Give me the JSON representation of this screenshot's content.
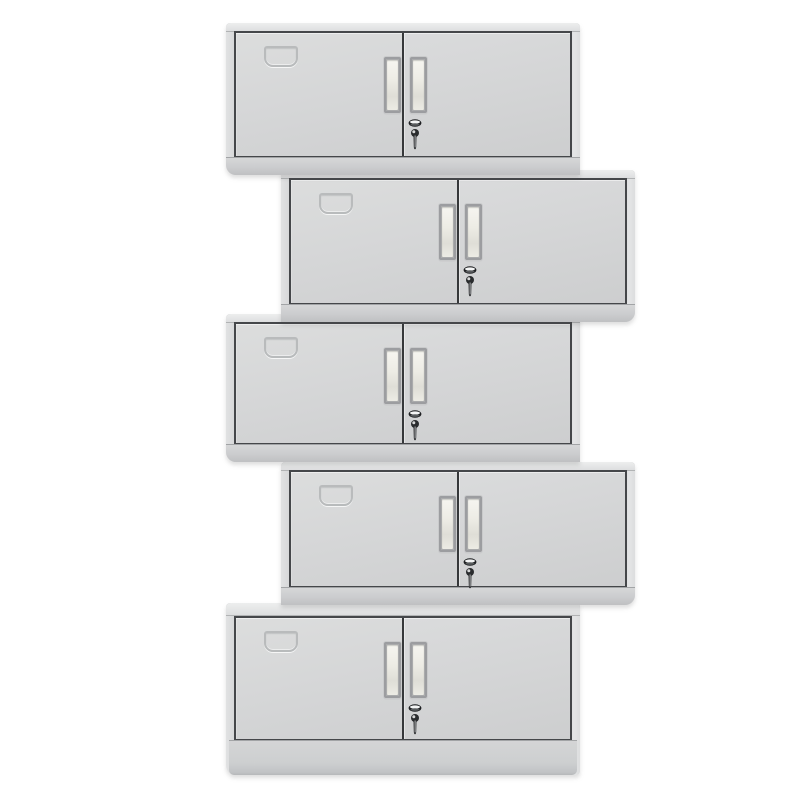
{
  "scene": {
    "type": "product-photo",
    "subject": "Five identical light-gray two-door steel office cabinets stacked vertically in an alternating left/right zigzag offset",
    "background_color": "#ffffff",
    "visible_text": "none"
  },
  "colors": {
    "cabinet_body": "#d5d6d7",
    "door_panel_light": "#dcdddd",
    "door_panel_dark": "#cfd0d1",
    "frame_line": "#45474a",
    "door_gap_line": "#36383a",
    "top_edge_highlight": "#edeeee",
    "bottom_edge_shade": "#bfc0c2",
    "handle_frame": "#9c9da0",
    "handle_slot": "#f5f4ef",
    "emboss_line": "#a8aaac",
    "lock_metal_dark": "#1f2123",
    "lock_highlight": "#f4f5f5"
  },
  "cabinets": [
    {
      "id": "cabinet-1",
      "align": "left",
      "doors": 2,
      "handles": 2,
      "label_holder": true,
      "lock": true,
      "key_inserted": true,
      "plinth": false
    },
    {
      "id": "cabinet-2",
      "align": "right",
      "doors": 2,
      "handles": 2,
      "label_holder": true,
      "lock": true,
      "key_inserted": true,
      "plinth": false
    },
    {
      "id": "cabinet-3",
      "align": "left",
      "doors": 2,
      "handles": 2,
      "label_holder": true,
      "lock": true,
      "key_inserted": true,
      "plinth": false
    },
    {
      "id": "cabinet-4",
      "align": "right",
      "doors": 2,
      "handles": 2,
      "label_holder": true,
      "lock": true,
      "key_inserted": true,
      "plinth": false
    },
    {
      "id": "cabinet-5",
      "align": "left",
      "doors": 2,
      "handles": 2,
      "label_holder": true,
      "lock": true,
      "key_inserted": true,
      "plinth": true
    }
  ]
}
